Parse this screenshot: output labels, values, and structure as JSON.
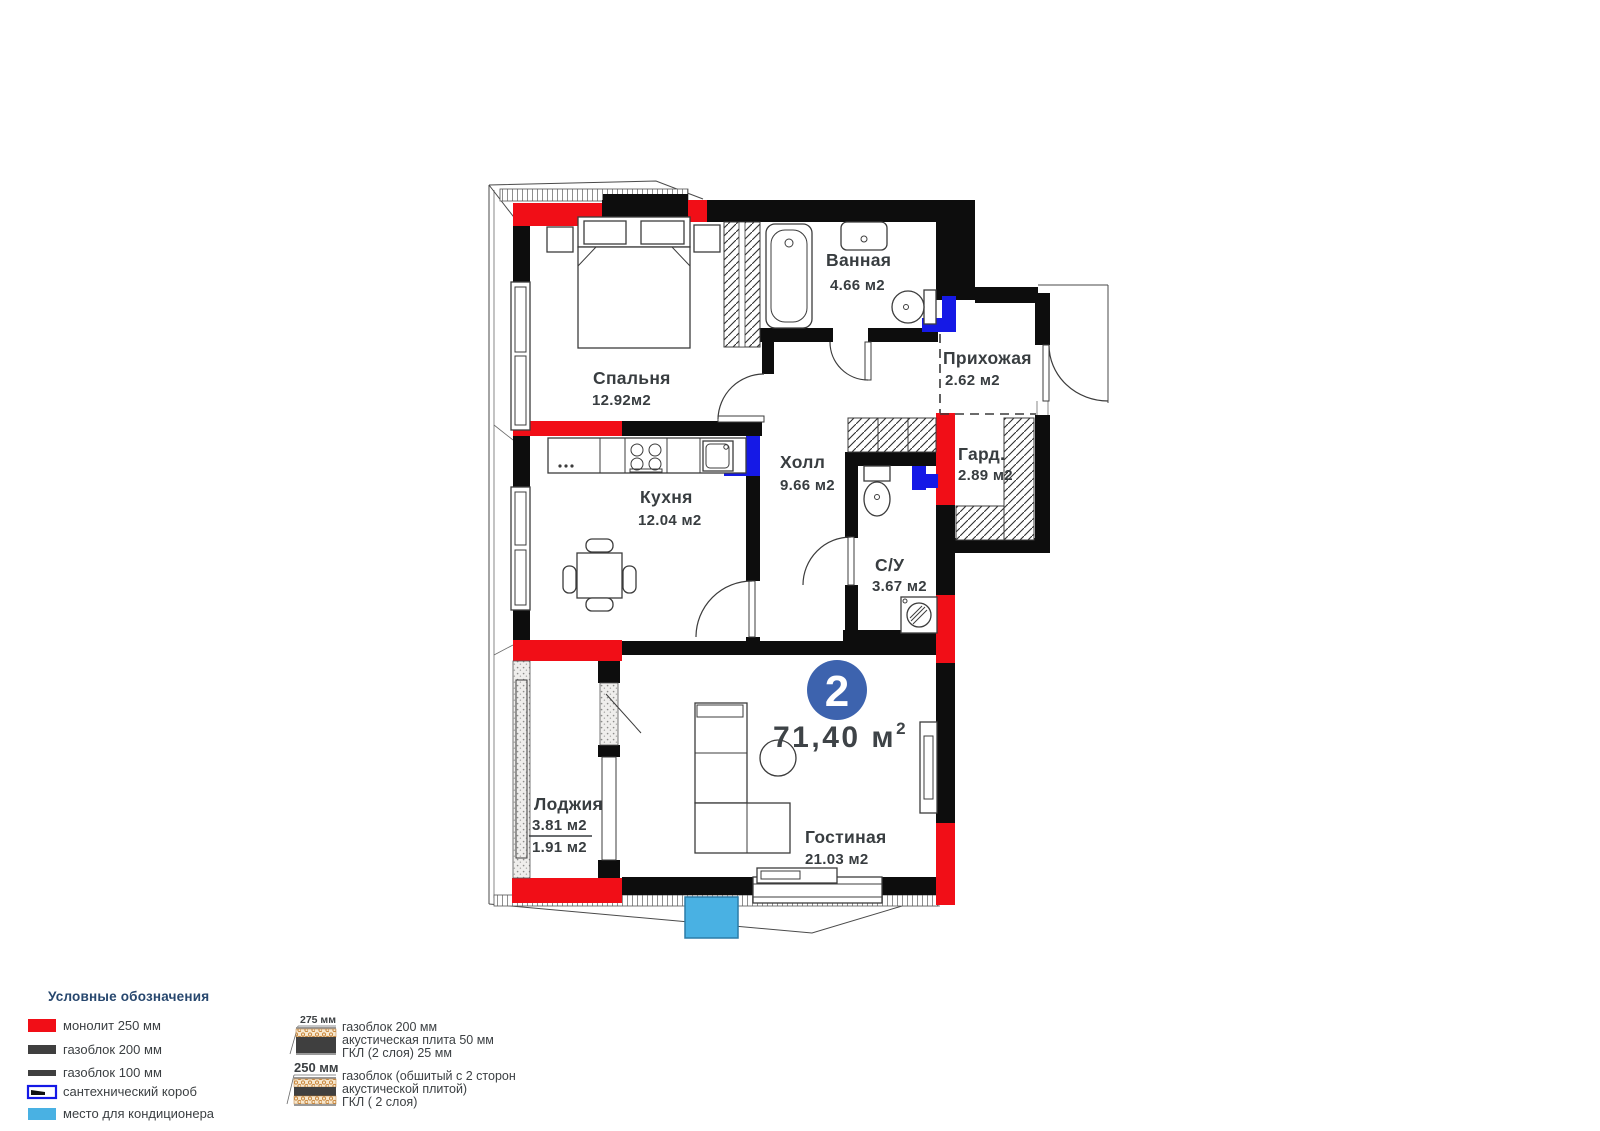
{
  "plan": {
    "unit_badge": {
      "number": "2"
    },
    "total_area": {
      "value": "71,40 м",
      "sup": "2"
    },
    "rooms": {
      "bedroom": {
        "name": "Спальня",
        "area": "12.92м2"
      },
      "bathroom": {
        "name": "Ванная",
        "area": "4.66 м2"
      },
      "entry": {
        "name": "Прихожая",
        "area": "2.62 м2"
      },
      "hall": {
        "name": "Холл",
        "area": "9.66 м2"
      },
      "wardrobe": {
        "name": "Гард.",
        "area": "2.89 м2"
      },
      "kitchen": {
        "name": "Кухня",
        "area": "12.04 м2"
      },
      "wc": {
        "name": "С/У",
        "area": "3.67 м2"
      },
      "living": {
        "name": "Гостиная",
        "area": "21.03 м2"
      },
      "loggia": {
        "name": "Лоджия",
        "area_full": "3.81 м2",
        "area_half": "1.91 м2"
      }
    }
  },
  "legend": {
    "title": "Условные обозначения",
    "items": [
      {
        "label": "монолит 250 мм",
        "color": "#f10e17"
      },
      {
        "label": "газоблок 200 мм",
        "color": "#3f3f3f"
      },
      {
        "label": "газоблок 100 мм",
        "color": "#3f3f3f"
      },
      {
        "label": "сантехнический короб",
        "color": "#1519e6"
      },
      {
        "label": "место для кондиционера",
        "color": "#49b1e3"
      }
    ],
    "wall_types": [
      {
        "thickness": "275 мм",
        "lines": [
          "газоблок 200 мм",
          "акустическая плита 50 мм",
          "ГКЛ (2 слоя) 25 мм"
        ]
      },
      {
        "thickness": "250 мм",
        "lines": [
          "газоблок (обшитый с 2 сторон",
          "акустической плитой)",
          "ГКЛ ( 2 слоя)"
        ]
      }
    ]
  },
  "colors": {
    "monolith_red": "#f10e17",
    "sanitary_blue": "#1519e6",
    "ac_blue": "#49b1e3",
    "badge_blue": "#3d63ae",
    "wall_black": "#0d0d0d",
    "text_dark": "#383d40",
    "legend_header": "#27476e"
  }
}
